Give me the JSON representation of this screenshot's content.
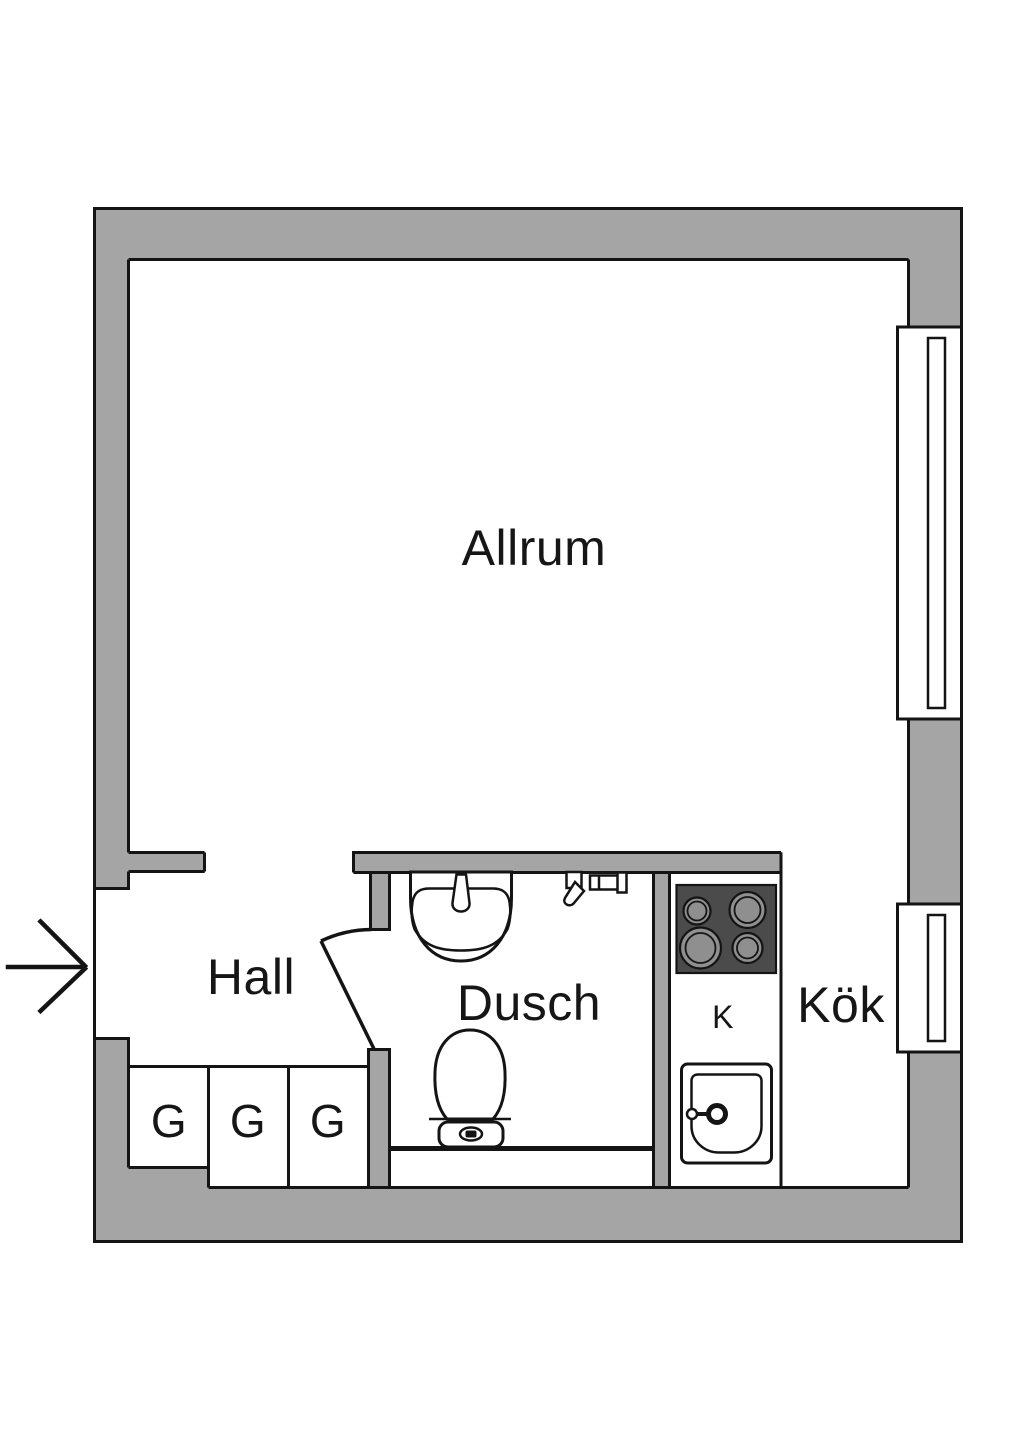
{
  "title": "Studio apartment floor plan",
  "labels": {
    "living_room": "Allrum",
    "hall": "Hall",
    "shower_room": "Dusch",
    "kitchen": "Kök",
    "fridge": "K",
    "wardrobes": [
      "G",
      "G",
      "G"
    ]
  },
  "symbols": {
    "entrance_arrow_direction": "right",
    "window_count": 2,
    "fixtures": [
      "washbasin",
      "shower-mixer",
      "toilet",
      "stove",
      "kitchen-sink"
    ]
  },
  "colors": {
    "wall": "#a5a5a5",
    "outline": "#141414",
    "stove": "#4b4b4b",
    "burner": "#8f8f8f",
    "label": "#161616",
    "background": "#ffffff"
  }
}
